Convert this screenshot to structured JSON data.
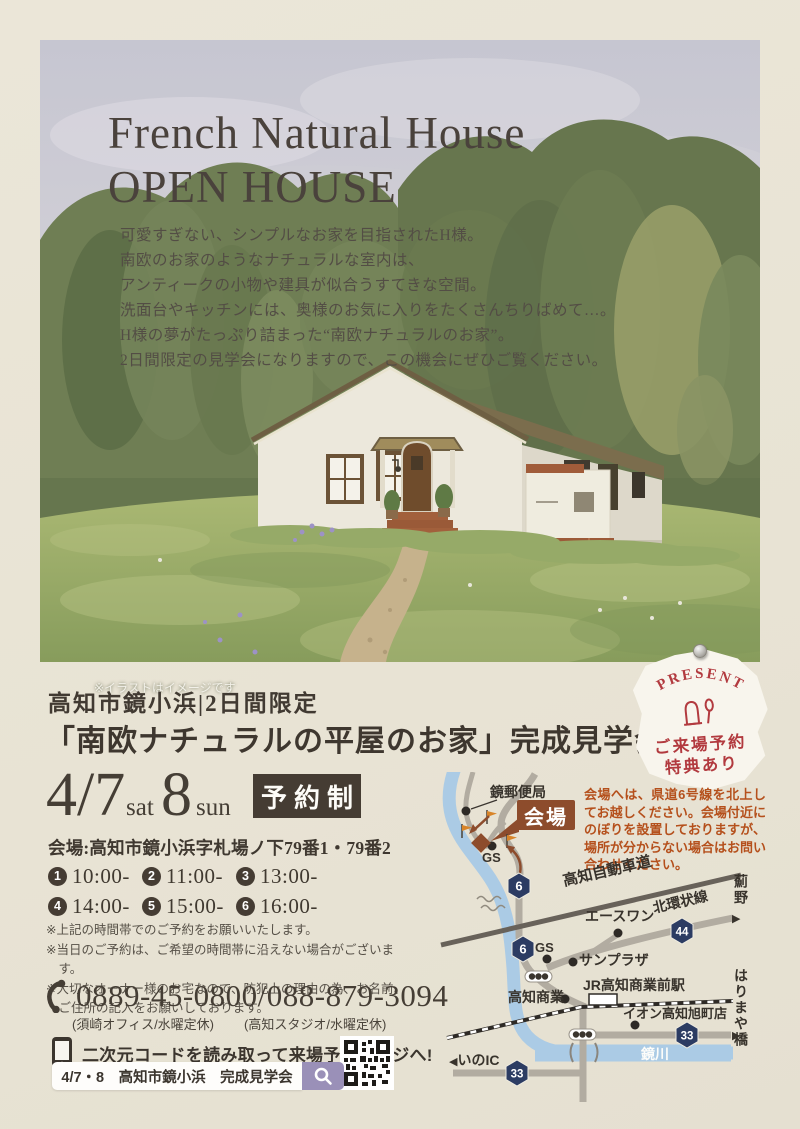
{
  "hero": {
    "title_line1": "French Natural House",
    "title_line2": "OPEN HOUSE",
    "intro_lines": [
      "可愛すぎない、シンプルなお家を目指されたH様。",
      "南欧のお家のようなナチュラルな室内は、",
      "アンティークの小物や建具が似合うすてきな空間。",
      "洗面台やキッチンには、奥様のお気に入りをたくさんちりばめて…。",
      "H様の夢がたっぷり詰まった“南欧ナチュラルのお家”。",
      "2日間限定の見学会になりますので、この機会にぜひご覧ください。"
    ],
    "caption": "※イラストはイメージです"
  },
  "headline": {
    "sub": "高知市鏡小浜|2日間限定",
    "main": "「南欧ナチュラルの平屋のお家」完成見学会"
  },
  "badge": {
    "top": "PRESENT",
    "line1": "ご来場予約",
    "line2": "特典あり"
  },
  "event": {
    "date": {
      "d1": "4/7",
      "d1_label": "sat",
      "d2": "8",
      "d2_label": "sun"
    },
    "reservation_label": "予約制",
    "venue": "会場:高知市鏡小浜字札場ノ下79番1・79番2",
    "slots": [
      {
        "n": "1",
        "t": "10:00-"
      },
      {
        "n": "2",
        "t": "11:00-"
      },
      {
        "n": "3",
        "t": "13:00-"
      },
      {
        "n": "4",
        "t": "14:00-"
      },
      {
        "n": "5",
        "t": "15:00-"
      },
      {
        "n": "6",
        "t": "16:00-"
      }
    ],
    "notes": [
      "※上記の時間帯でのご予約をお願いいたします。",
      "※当日のご予約は、ご希望の時間帯に沿えない場合がございます。",
      "※大切なオーナー様のお宅なので、防犯上の理由の為、お名前、ご住所の記入をお願いしております。"
    ],
    "phone": {
      "number1": "0889-45-0800",
      "sep": "/",
      "number2": "088-879-3094",
      "office1": "(須崎オフィス/水曜定休)",
      "office2": "(高知スタジオ/水曜定休)"
    },
    "qr_lead": "二次元コードを読み取って来場予約ページへ!",
    "search_text": "4/7・8　高知市鏡小浜　完成見学会"
  },
  "map": {
    "notice": "会場へは、県道6号線を北上してお越しください。会場付近にのぼりを設置しておりますが、場所が分からない場合はお問い合わせください。",
    "labels": {
      "postoffice": "鏡郵便局",
      "venue": "会場",
      "gs": "GS",
      "expressway": "高知自動車道",
      "aceone": "エースワン",
      "kitakanjo": "北環状線",
      "azono": "薊野",
      "sunplaza": "サンプラザ",
      "kochishogyo": "高知商業",
      "jrstation": "JR高知商業前駅",
      "ion": "イオン高知旭町店",
      "kagamigawa": "鏡川",
      "inoic": "いのIC",
      "harimaya": "はりまや橋"
    },
    "shields": {
      "r6": "6",
      "r44": "44",
      "r33": "33"
    },
    "icons": {
      "arrow_left": "◀",
      "arrow_right": "▶"
    }
  },
  "colors": {
    "paper": "#e9e4d6",
    "dark": "#453c33",
    "accent_brown": "#8d4c2c",
    "notice_red": "#b5501c",
    "navy": "#2c3c63",
    "river_blue": "#abcbe5",
    "flag_orange": "#d88428",
    "lavender": "#9a90b8",
    "badge_red": "#b23a3f"
  }
}
